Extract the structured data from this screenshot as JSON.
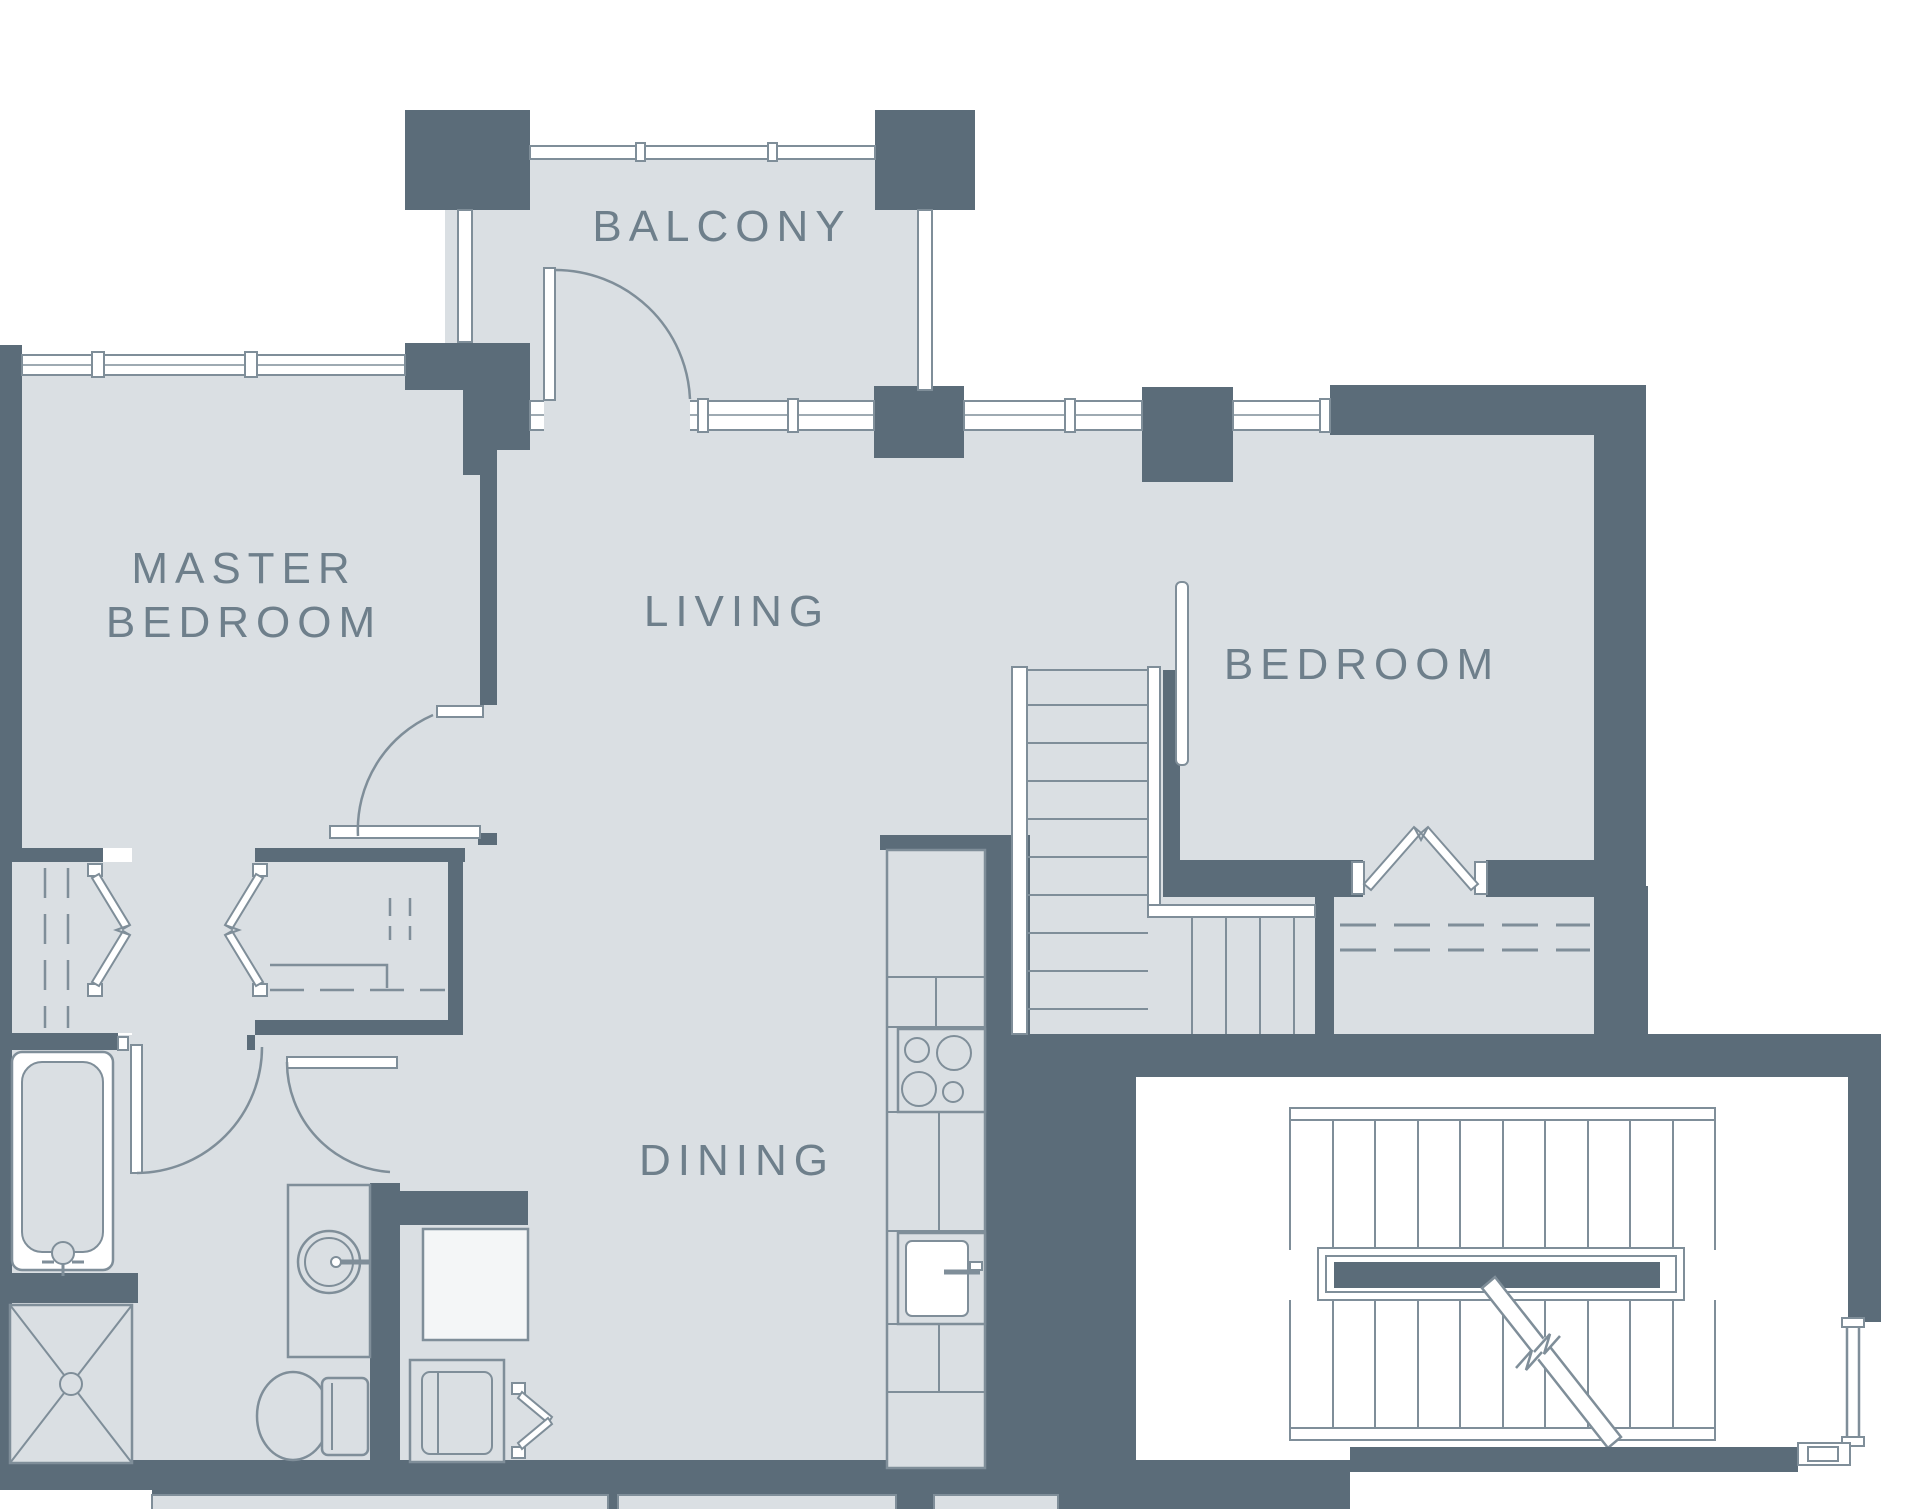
{
  "document": {
    "type": "architectural-floor-plan",
    "units_shown": "none",
    "dimensions_shown": "none"
  },
  "colors": {
    "floor_fill": "#dadfe3",
    "wall_fill": "#5b6c79",
    "line": "#7f8e99",
    "label_text": "#6e7f8b",
    "exterior": "#ffffff",
    "light_fixture_fill": "#f4f6f7"
  },
  "labels": {
    "balcony": "BALCONY",
    "master_bedroom_line1": "MASTER",
    "master_bedroom_line2": "BEDROOM",
    "living": "LIVING",
    "bedroom": "BEDROOM",
    "dining": "DINING"
  },
  "rooms": [
    {
      "name": "balcony",
      "label": "BALCONY"
    },
    {
      "name": "master-bedroom",
      "label": "MASTER BEDROOM"
    },
    {
      "name": "living",
      "label": "LIVING"
    },
    {
      "name": "dining",
      "label": "DINING"
    },
    {
      "name": "bedroom",
      "label": "BEDROOM"
    },
    {
      "name": "bathroom",
      "label": ""
    },
    {
      "name": "walk-in-closet",
      "label": ""
    },
    {
      "name": "laundry-closet",
      "label": ""
    },
    {
      "name": "common-stairwell",
      "label": ""
    }
  ],
  "fixtures": [
    "bathtub",
    "shower",
    "vanity-round-sink",
    "toilet",
    "washer",
    "kitchen-counter",
    "cooktop-4-burners",
    "kitchen-sink",
    "internal-l-staircase",
    "common-stairwell-double-flight",
    "stair-direction-arrow",
    "balcony-swing-door",
    "master-bedroom-swing-door",
    "bathroom-swing-door",
    "wc-swing-door",
    "bifold-closet-doors",
    "window-bands",
    "structural-columns"
  ]
}
